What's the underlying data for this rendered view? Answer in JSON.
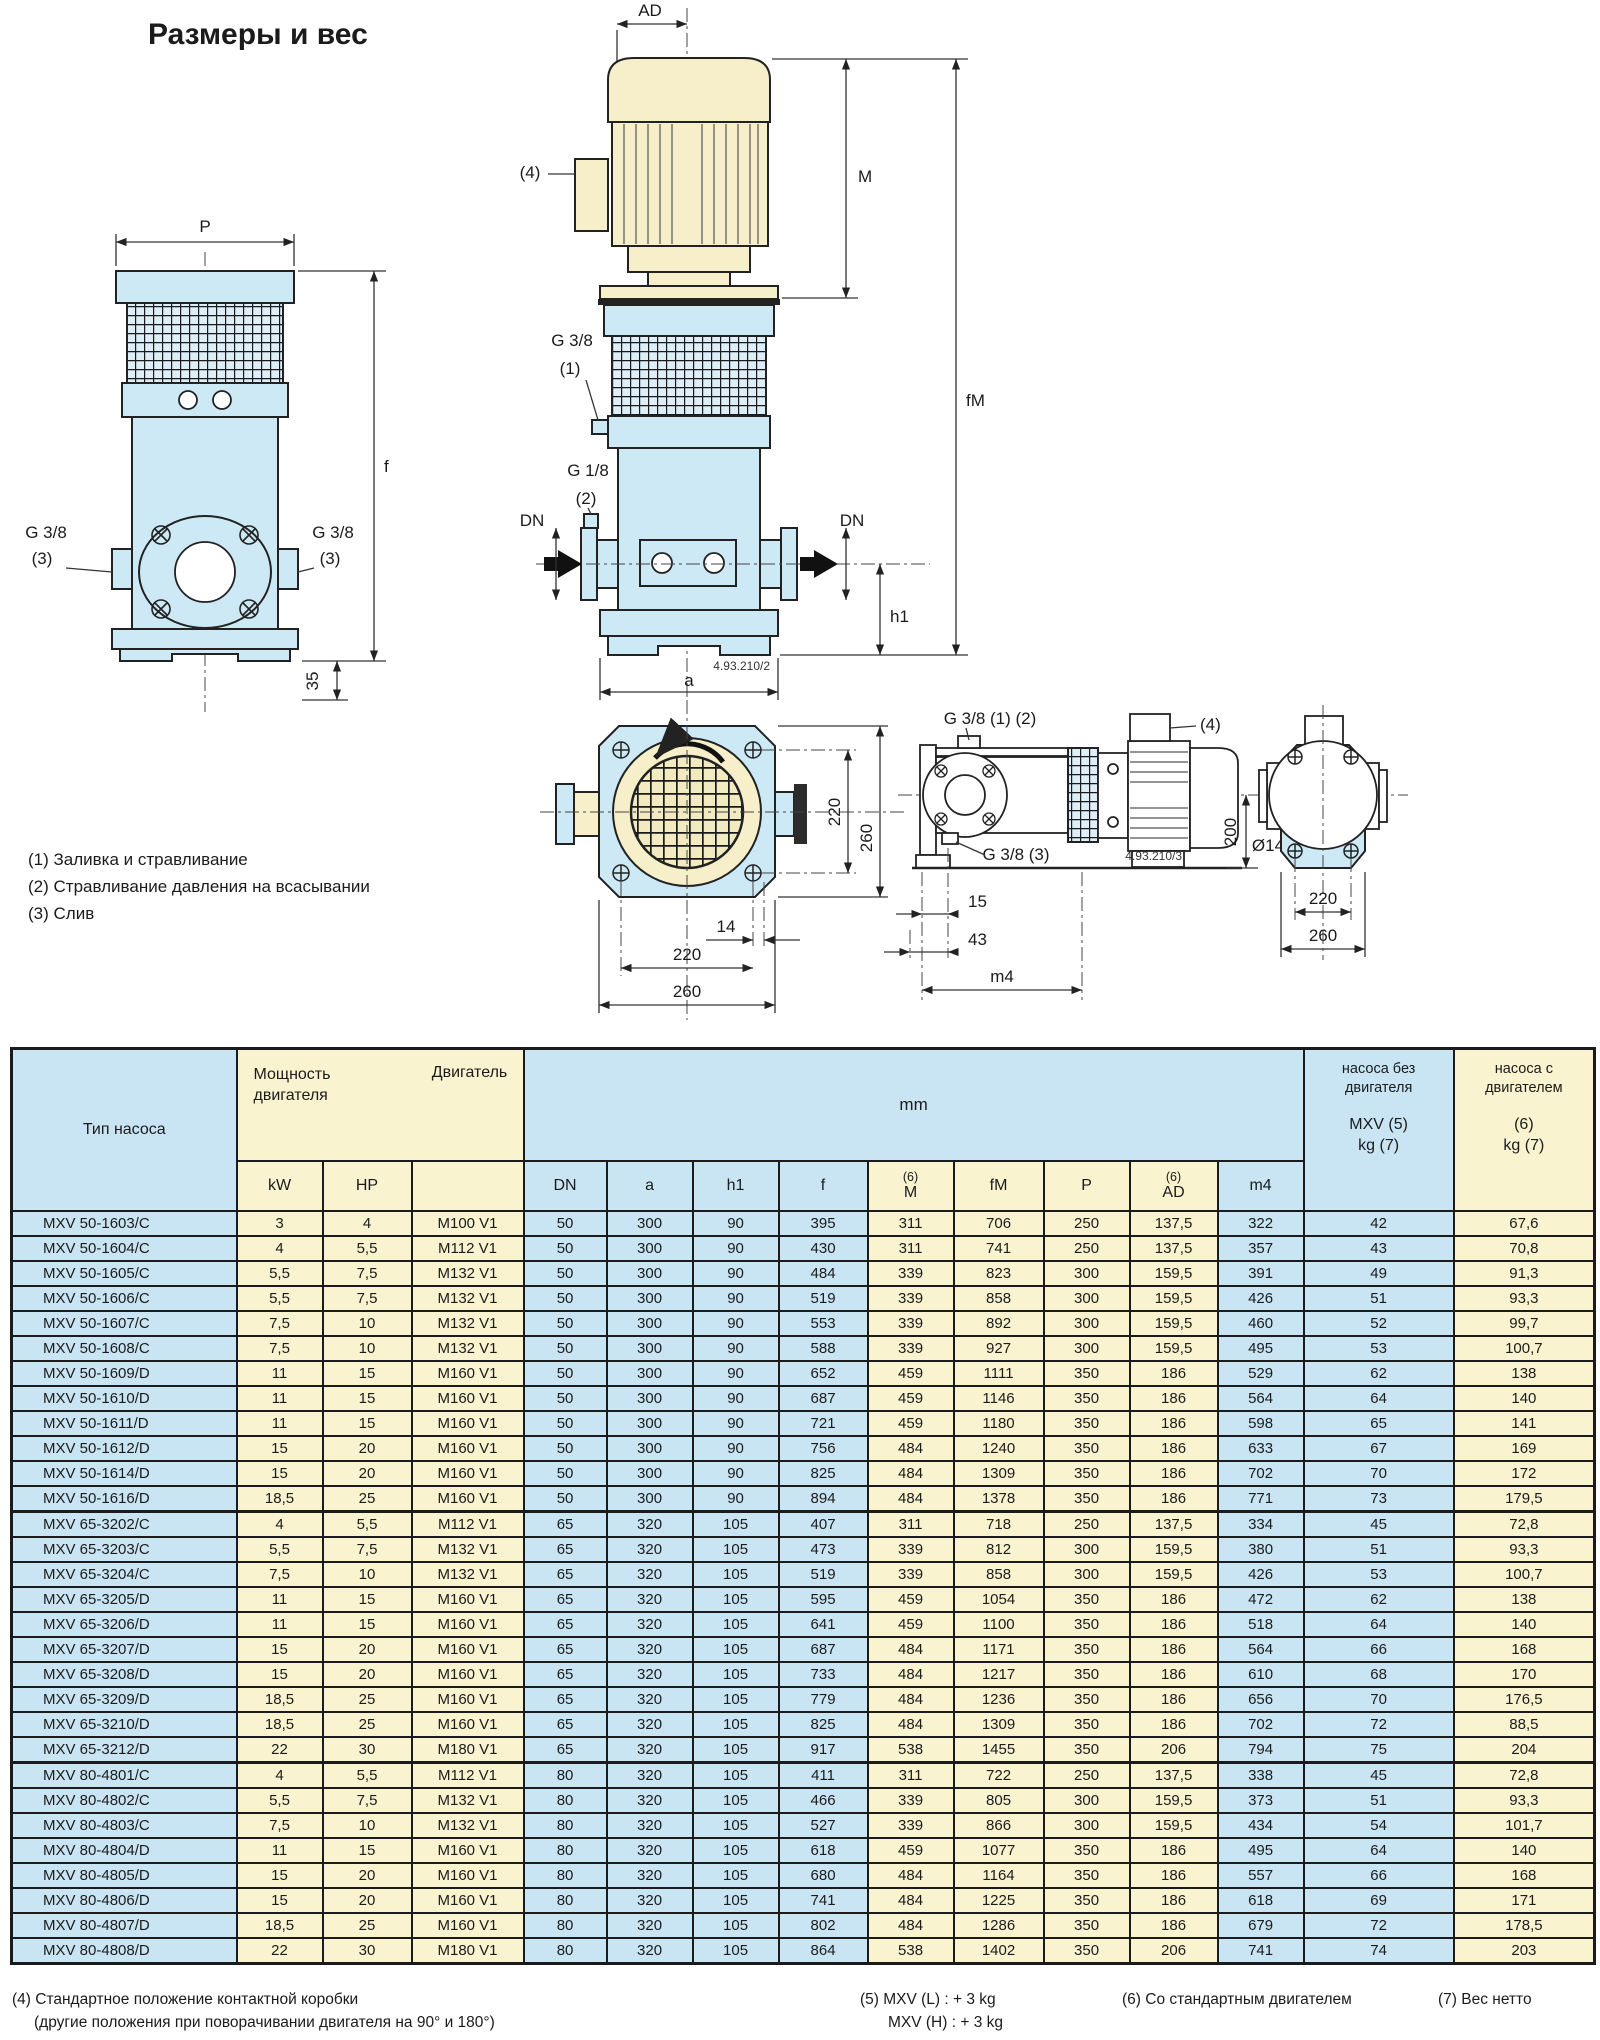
{
  "title": "Размеры и вес",
  "drawing": {
    "notes": "(1) Заливка и стравливание\n(2) Стравливание давления на всасывании\n(3) Слив",
    "labels": {
      "p": "P",
      "f": "f",
      "d35": "35",
      "g38": "G 3/8",
      "n3": "(3)",
      "n1": "(1)",
      "n2": "(2)",
      "n4": "(4)",
      "g18": "G 1/8",
      "ad": "AD",
      "m": "M",
      "fm": "fM",
      "dn": "DN",
      "h1": "h1",
      "a": "a",
      "code2": "4.93.210/2",
      "code3": "4.93.210/3",
      "d14": "14",
      "d220": "220",
      "d260": "260",
      "g38_12": "G 3/8 (1) (2)",
      "g38_3": "G 3/8 (3)",
      "d15": "15",
      "d43": "43",
      "m4": "m4",
      "d200": "200",
      "dia14": "Ø14"
    }
  },
  "table": {
    "headers": {
      "type": "Тип насоса",
      "power": "Мощность\nдвигателя",
      "motor": "Двигатель",
      "mm": "mm",
      "kw": "kW",
      "hp": "HP",
      "dn": "DN",
      "a": "a",
      "h1": "h1",
      "f": "f",
      "note6": "(6)",
      "m": "M",
      "fm": "fM",
      "p": "P",
      "ad": "AD",
      "m4": "m4",
      "kg_pump_top": "насоса без\nдвигателя",
      "kg_pump_bottom": "MXV (5)\nkg (7)",
      "kg_motor_top": "насоса с\nдвигателем",
      "kg_motor_bottom": "(6)\nkg (7)"
    },
    "groups": [
      {
        "rows": [
          [
            "MXV 50-1603/C",
            "3",
            "4",
            "M100 V1",
            "50",
            "300",
            "90",
            "395",
            "311",
            "706",
            "250",
            "137,5",
            "322",
            "42",
            "67,6"
          ],
          [
            "MXV 50-1604/C",
            "4",
            "5,5",
            "M112 V1",
            "50",
            "300",
            "90",
            "430",
            "311",
            "741",
            "250",
            "137,5",
            "357",
            "43",
            "70,8"
          ],
          [
            "MXV 50-1605/C",
            "5,5",
            "7,5",
            "M132 V1",
            "50",
            "300",
            "90",
            "484",
            "339",
            "823",
            "300",
            "159,5",
            "391",
            "49",
            "91,3"
          ],
          [
            "MXV 50-1606/C",
            "5,5",
            "7,5",
            "M132 V1",
            "50",
            "300",
            "90",
            "519",
            "339",
            "858",
            "300",
            "159,5",
            "426",
            "51",
            "93,3"
          ],
          [
            "MXV 50-1607/C",
            "7,5",
            "10",
            "M132 V1",
            "50",
            "300",
            "90",
            "553",
            "339",
            "892",
            "300",
            "159,5",
            "460",
            "52",
            "99,7"
          ],
          [
            "MXV 50-1608/C",
            "7,5",
            "10",
            "M132 V1",
            "50",
            "300",
            "90",
            "588",
            "339",
            "927",
            "300",
            "159,5",
            "495",
            "53",
            "100,7"
          ],
          [
            "MXV 50-1609/D",
            "11",
            "15",
            "M160 V1",
            "50",
            "300",
            "90",
            "652",
            "459",
            "1111",
            "350",
            "186",
            "529",
            "62",
            "138"
          ],
          [
            "MXV 50-1610/D",
            "11",
            "15",
            "M160 V1",
            "50",
            "300",
            "90",
            "687",
            "459",
            "1146",
            "350",
            "186",
            "564",
            "64",
            "140"
          ],
          [
            "MXV 50-1611/D",
            "11",
            "15",
            "M160 V1",
            "50",
            "300",
            "90",
            "721",
            "459",
            "1180",
            "350",
            "186",
            "598",
            "65",
            "141"
          ],
          [
            "MXV 50-1612/D",
            "15",
            "20",
            "M160 V1",
            "50",
            "300",
            "90",
            "756",
            "484",
            "1240",
            "350",
            "186",
            "633",
            "67",
            "169"
          ],
          [
            "MXV 50-1614/D",
            "15",
            "20",
            "M160 V1",
            "50",
            "300",
            "90",
            "825",
            "484",
            "1309",
            "350",
            "186",
            "702",
            "70",
            "172"
          ],
          [
            "MXV 50-1616/D",
            "18,5",
            "25",
            "M160 V1",
            "50",
            "300",
            "90",
            "894",
            "484",
            "1378",
            "350",
            "186",
            "771",
            "73",
            "179,5"
          ]
        ]
      },
      {
        "rows": [
          [
            "MXV 65-3202/C",
            "4",
            "5,5",
            "M112 V1",
            "65",
            "320",
            "105",
            "407",
            "311",
            "718",
            "250",
            "137,5",
            "334",
            "45",
            "72,8"
          ],
          [
            "MXV 65-3203/C",
            "5,5",
            "7,5",
            "M132 V1",
            "65",
            "320",
            "105",
            "473",
            "339",
            "812",
            "300",
            "159,5",
            "380",
            "51",
            "93,3"
          ],
          [
            "MXV 65-3204/C",
            "7,5",
            "10",
            "M132 V1",
            "65",
            "320",
            "105",
            "519",
            "339",
            "858",
            "300",
            "159,5",
            "426",
            "53",
            "100,7"
          ],
          [
            "MXV 65-3205/D",
            "11",
            "15",
            "M160 V1",
            "65",
            "320",
            "105",
            "595",
            "459",
            "1054",
            "350",
            "186",
            "472",
            "62",
            "138"
          ],
          [
            "MXV 65-3206/D",
            "11",
            "15",
            "M160 V1",
            "65",
            "320",
            "105",
            "641",
            "459",
            "1100",
            "350",
            "186",
            "518",
            "64",
            "140"
          ],
          [
            "MXV 65-3207/D",
            "15",
            "20",
            "M160 V1",
            "65",
            "320",
            "105",
            "687",
            "484",
            "1171",
            "350",
            "186",
            "564",
            "66",
            "168"
          ],
          [
            "MXV 65-3208/D",
            "15",
            "20",
            "M160 V1",
            "65",
            "320",
            "105",
            "733",
            "484",
            "1217",
            "350",
            "186",
            "610",
            "68",
            "170"
          ],
          [
            "MXV 65-3209/D",
            "18,5",
            "25",
            "M160 V1",
            "65",
            "320",
            "105",
            "779",
            "484",
            "1236",
            "350",
            "186",
            "656",
            "70",
            "176,5"
          ],
          [
            "MXV 65-3210/D",
            "18,5",
            "25",
            "M160 V1",
            "65",
            "320",
            "105",
            "825",
            "484",
            "1309",
            "350",
            "186",
            "702",
            "72",
            "88,5"
          ],
          [
            "MXV 65-3212/D",
            "22",
            "30",
            "M180 V1",
            "65",
            "320",
            "105",
            "917",
            "538",
            "1455",
            "350",
            "206",
            "794",
            "75",
            "204"
          ]
        ]
      },
      {
        "rows": [
          [
            "MXV 80-4801/C",
            "4",
            "5,5",
            "M112 V1",
            "80",
            "320",
            "105",
            "411",
            "311",
            "722",
            "250",
            "137,5",
            "338",
            "45",
            "72,8"
          ],
          [
            "MXV 80-4802/C",
            "5,5",
            "7,5",
            "M132 V1",
            "80",
            "320",
            "105",
            "466",
            "339",
            "805",
            "300",
            "159,5",
            "373",
            "51",
            "93,3"
          ],
          [
            "MXV 80-4803/C",
            "7,5",
            "10",
            "M132 V1",
            "80",
            "320",
            "105",
            "527",
            "339",
            "866",
            "300",
            "159,5",
            "434",
            "54",
            "101,7"
          ],
          [
            "MXV 80-4804/D",
            "11",
            "15",
            "M160 V1",
            "80",
            "320",
            "105",
            "618",
            "459",
            "1077",
            "350",
            "186",
            "495",
            "64",
            "140"
          ],
          [
            "MXV 80-4805/D",
            "15",
            "20",
            "M160 V1",
            "80",
            "320",
            "105",
            "680",
            "484",
            "1164",
            "350",
            "186",
            "557",
            "66",
            "168"
          ],
          [
            "MXV 80-4806/D",
            "15",
            "20",
            "M160 V1",
            "80",
            "320",
            "105",
            "741",
            "484",
            "1225",
            "350",
            "186",
            "618",
            "69",
            "171"
          ],
          [
            "MXV 80-4807/D",
            "18,5",
            "25",
            "M160 V1",
            "80",
            "320",
            "105",
            "802",
            "484",
            "1286",
            "350",
            "186",
            "679",
            "72",
            "178,5"
          ],
          [
            "MXV 80-4808/D",
            "22",
            "30",
            "M180 V1",
            "80",
            "320",
            "105",
            "864",
            "538",
            "1402",
            "350",
            "206",
            "741",
            "74",
            "203"
          ]
        ]
      }
    ]
  },
  "footnotes": {
    "f4a": "(4) Стандартное положение контактной коробки",
    "f4b": "(другие положения при поворачивании двигателя на 90° и 180°)",
    "f5a": "(5) MXV (L) : + 3 kg",
    "f5b": "MXV (H) : + 3 kg",
    "f6": "(6) Со стандартным двигателем",
    "f7": "(7) Вес нетто"
  }
}
